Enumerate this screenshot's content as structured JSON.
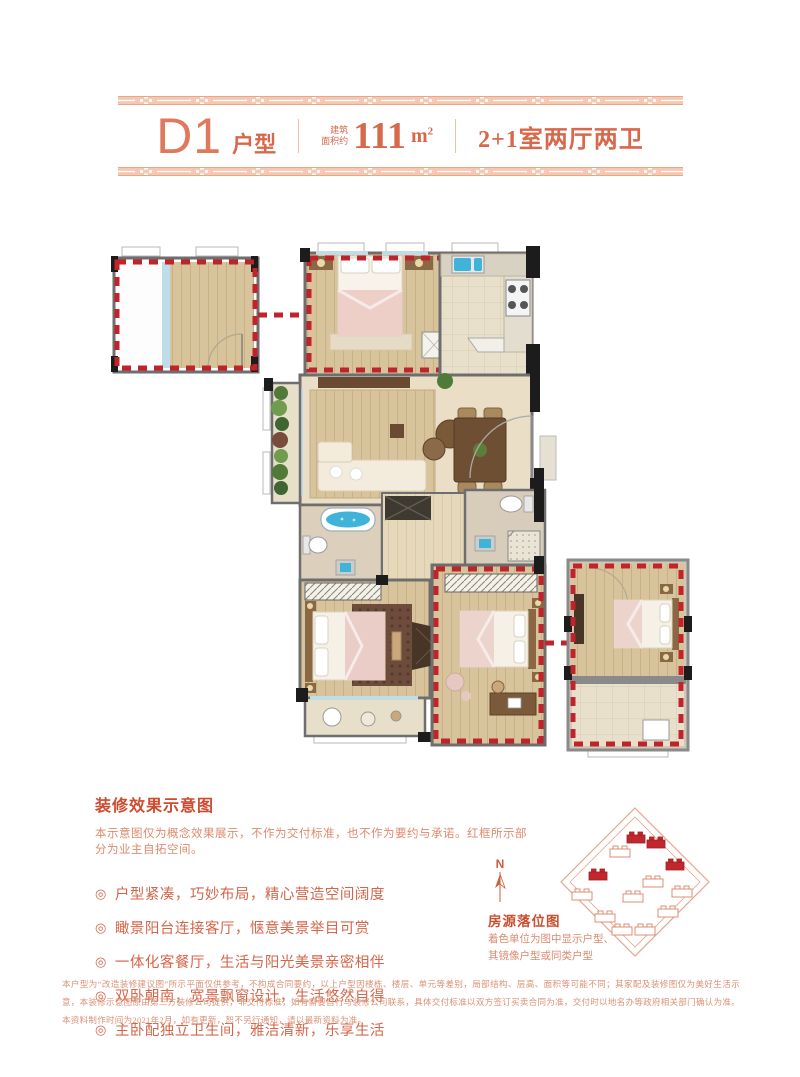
{
  "header": {
    "unit_code": "D1",
    "unit_suffix": "户型",
    "area_label_line1": "建筑",
    "area_label_line2": "面积约",
    "area_value": "111",
    "area_unit_base": "m",
    "area_unit_sup": "2",
    "layout": "2+1室两厅两卫"
  },
  "notes": {
    "heading": "装修效果示意图",
    "subheading": "本示意图仅为概念效果展示，不作为交付标准，也不作为要约与承诺。红框所示部分为业主自拓空间。",
    "bullet_icon": "◎",
    "bullets": [
      "户型紧凑，巧妙布局，精心营造空间阔度",
      "瞰景阳台连接客厅，惬意美景举目可赏",
      "一体化客餐厅，生活与阳光美景亲密相伴",
      "双卧朝南，宽景飘窗设计，生活悠然自得",
      "主卧配独立卫生间，雅洁清新，乐享生活"
    ]
  },
  "sitemap": {
    "compass_label": "N",
    "title": "房源落位图",
    "caption_line1": "着色单位为图中显示户型、",
    "caption_line2": "其镜像户型或同类户型"
  },
  "disclaimer": "本户型为“改造装修建议图”所示平面仅供参考，不构成合同要约，以上户型因楼栋、楼层、单元等差别，局部结构、层高、面积等可能不同；其家配及装修图仅为美好生活示意，本装修示意图原由第三方装修公司提供，非交付标准，如有需要自行与装修公司联系，具体交付标准以双方签订买卖合同为准，交付时以地名办等政府相关部门确认为准。本资料制作时间为2021年2月，如有更新，恕不另行通知，请以最新资料为准。",
  "colors": {
    "accent": "#d8684b",
    "band_pink": "#f4c8b3",
    "red_box": "#c1232b",
    "wood": "#d8c49c",
    "tile": "#e9e0cb"
  }
}
